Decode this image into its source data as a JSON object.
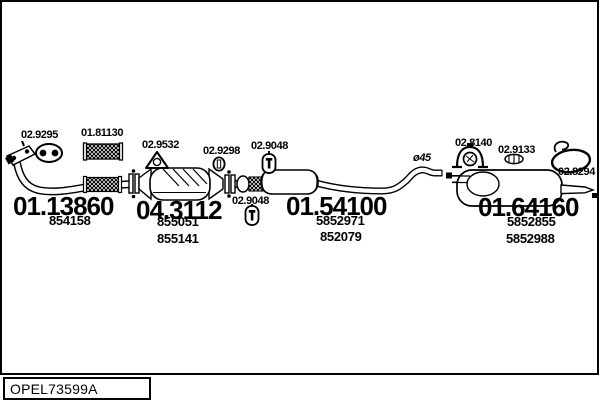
{
  "footer": {
    "code": "OPEL73599A"
  },
  "parts": {
    "front_pipe": {
      "code": "01.13860",
      "refs": [
        "854158"
      ]
    },
    "catalyst": {
      "code": "04.3112",
      "refs": [
        "855051",
        "855141"
      ]
    },
    "mid_muffler": {
      "code": "01.54100",
      "refs": [
        "5852971",
        "852079"
      ]
    },
    "rear_muffler": {
      "code": "01.64160",
      "refs": [
        "5852855",
        "5852988"
      ]
    }
  },
  "fittings": {
    "gasket_oval": "02.9295",
    "flex_pipe": "01.81130",
    "gasket_triangle": "02.9532",
    "clamp_ring": "02.9298",
    "hanger_front": "02.9048",
    "hanger_mid": "02.9048",
    "mount_bracket": "02.8140",
    "clamp_band": "02.9133",
    "hanger_ring": "02.8294"
  },
  "annotations": {
    "pipe_diameter": "ø45"
  },
  "colors": {
    "ink": "#000000",
    "paper": "#ffffff"
  }
}
